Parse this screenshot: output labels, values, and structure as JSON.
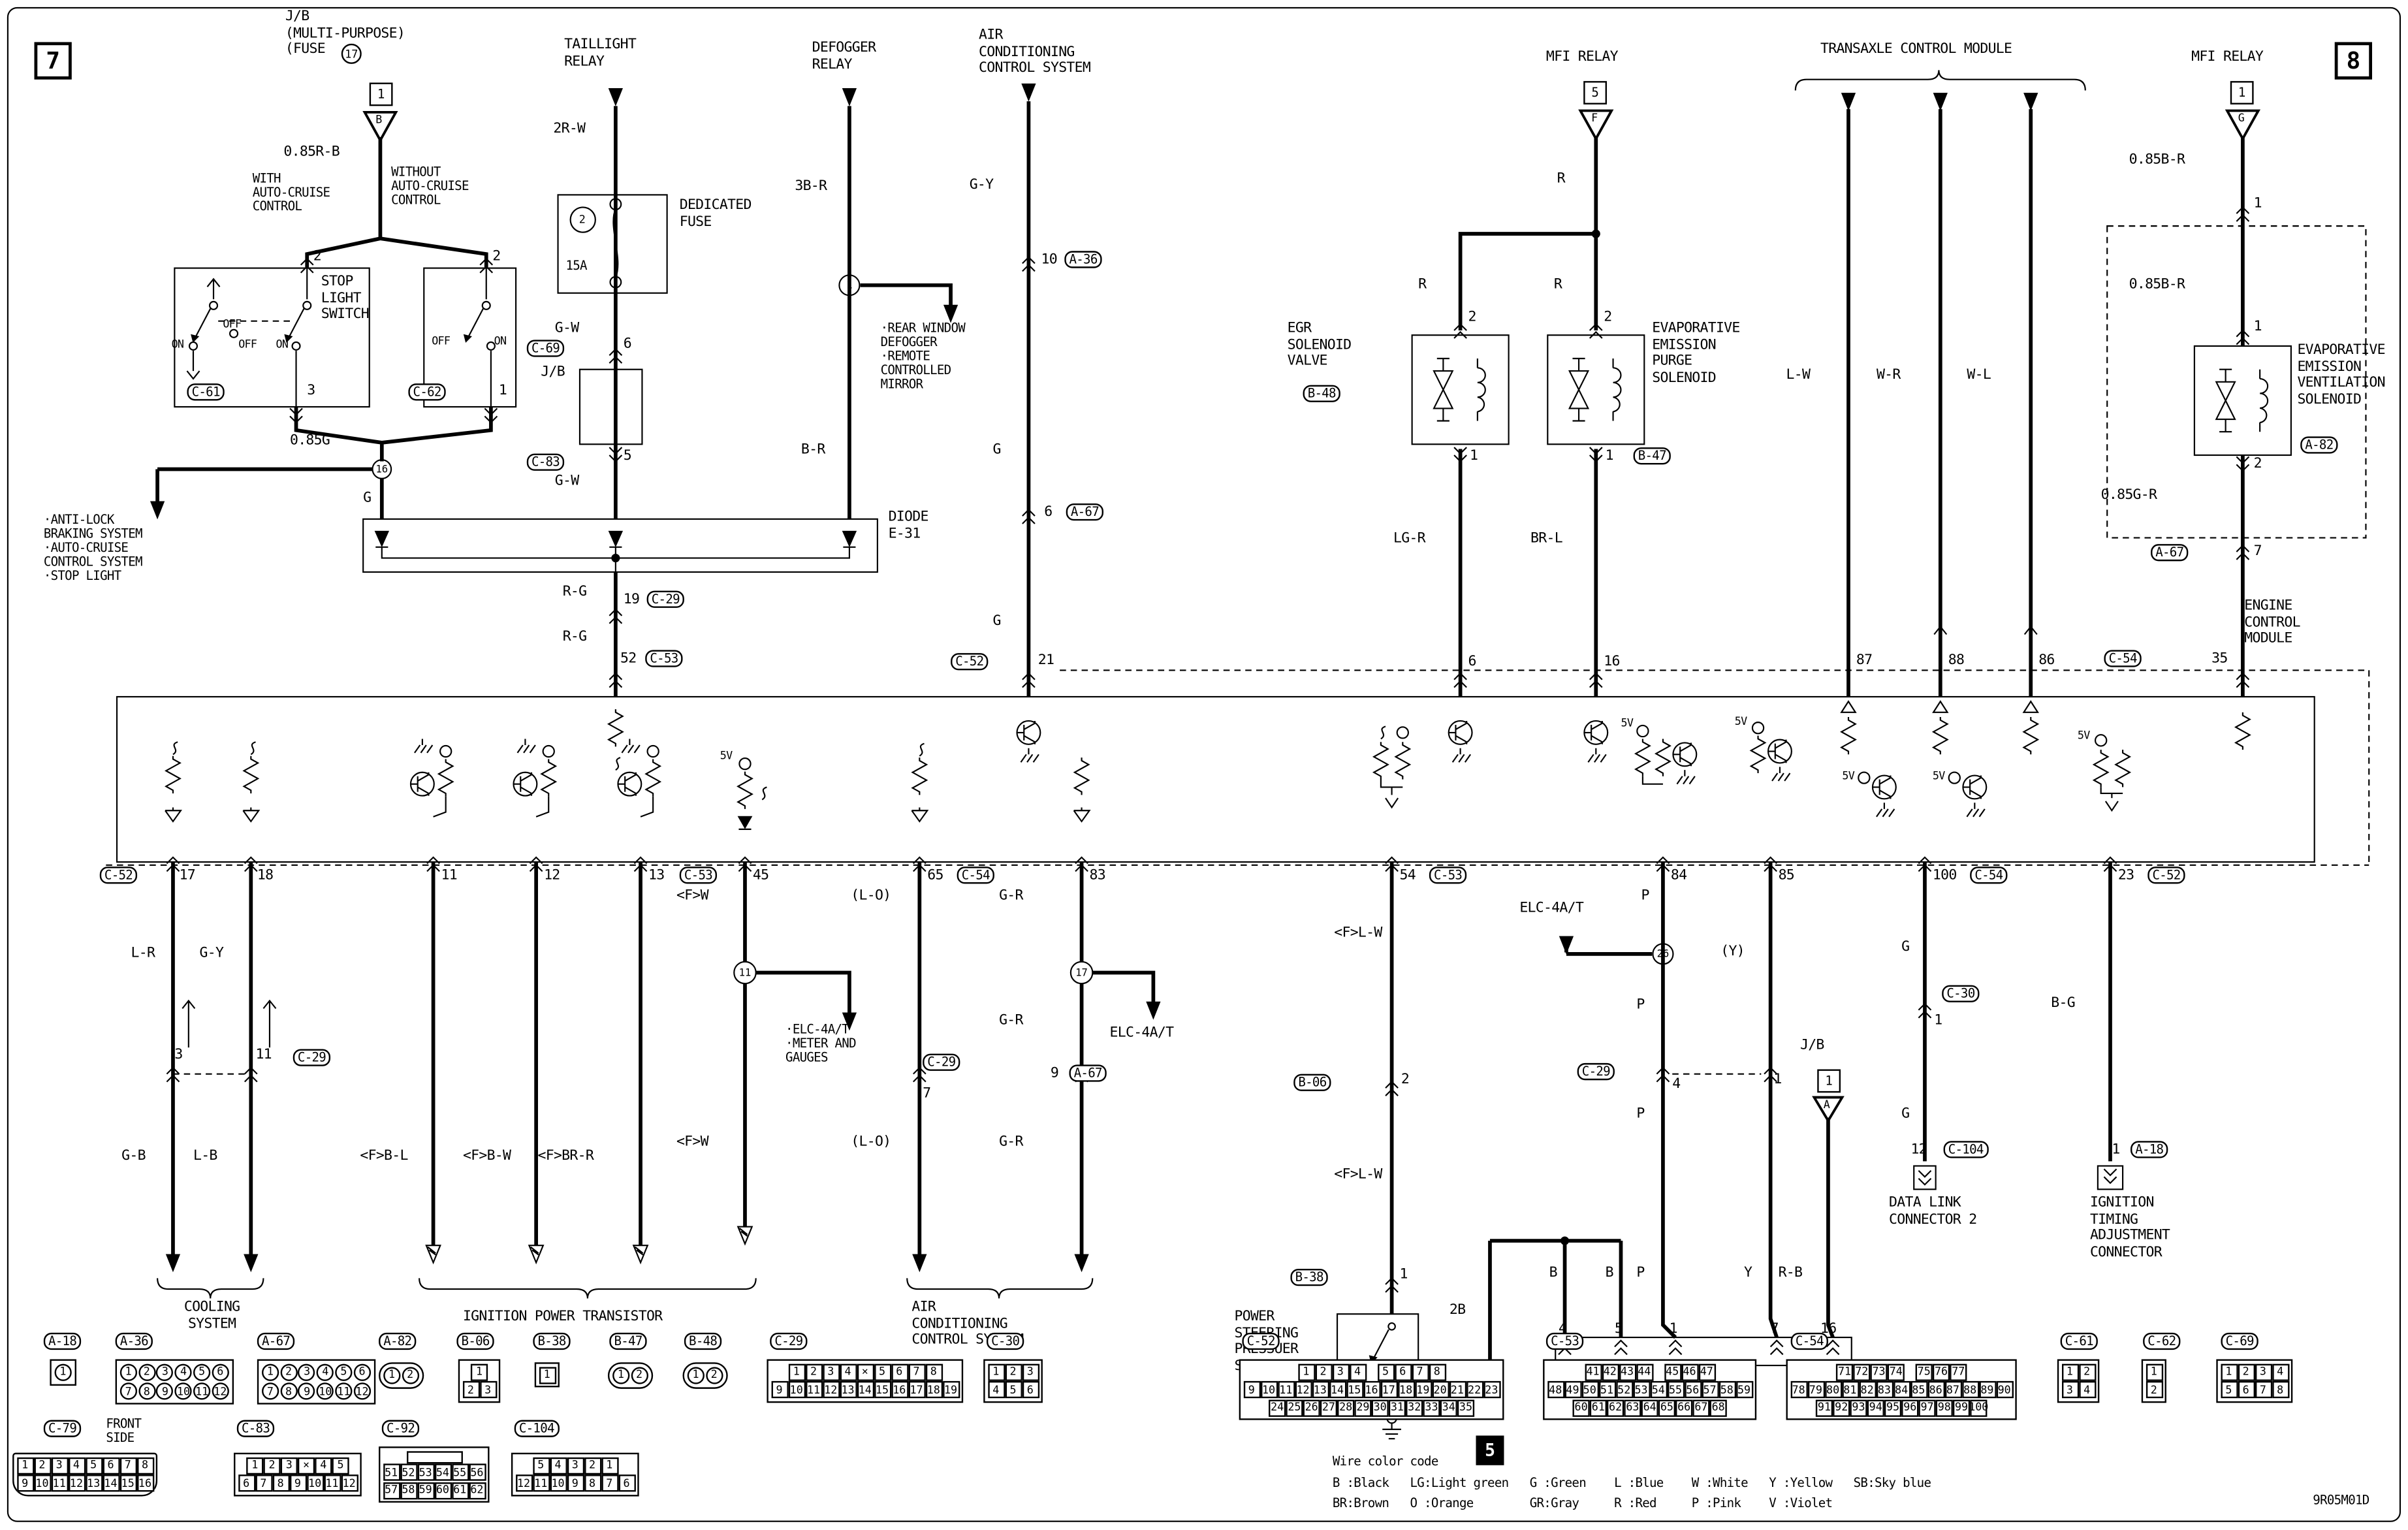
{
  "d": {
    "corner7": "7",
    "corner8": "8",
    "jb_label": "J/B\n(MULTI-PURPOSE)\n(FUSE",
    "jb_fuse_no": "17",
    "pin_b": "1",
    "tri_b": "B",
    "w085rb": "0.85R-B",
    "with_acc": "WITH\nAUTO-CRUISE\nCONTROL",
    "without_acc": "WITHOUT\nAUTO-CRUISE\nCONTROL",
    "p2": "2",
    "sls": "STOP\nLIGHT\nSWITCH",
    "on": "ON",
    "off": "OFF",
    "p3": "3",
    "p1": "1",
    "w085g": "0.85G",
    "j16": "16",
    "abs_list": "·ANTI-LOCK\n BRAKING SYSTEM\n·AUTO-CRUISE\n CONTROL SYSTEM\n·STOP LIGHT",
    "wg": "G",
    "tail_title": "TAILLIGHT\nRELAY",
    "w2rw": "2R-W",
    "dedicated": "DEDICATED\nFUSE",
    "f2": "2",
    "f15": "15A",
    "wgw": "G-W",
    "p6": "6",
    "jb": "J/B",
    "p5": "5",
    "def_title": "DEFOGGER\nRELAY",
    "w3br": "3B-R",
    "j1": "1",
    "def_list": "·REAR WINDOW\n DEFOGGER\n·REMOTE\n CONTROLLED\n MIRROR",
    "wbr": "B-R",
    "diode_name": "DIODE\nE-31",
    "wrg": "R-G",
    "p19": "19",
    "p52": "52",
    "act_title": "AIR\nCONDITIONING\nCONTROL SYSTEM",
    "wgy": "G-Y",
    "p10": "10",
    "p21": "21",
    "mfi": "MFI RELAY",
    "b5": "5",
    "tri_f": "F",
    "wr": "R",
    "egr": "EGR\nSOLENOID\nVALVE",
    "evap": "EVAPORATIVE\nEMISSION\nPURGE\nSOLENOID",
    "wlgr": "LG-R",
    "wbrl": "BR-L",
    "p16": "16",
    "tcm": "TRANSAXLE CONTROL MODULE",
    "wlw": "L-W",
    "wwr": "W-R",
    "wwl": "W-L",
    "p87": "87",
    "p88": "88",
    "p86": "86",
    "b1": "1",
    "tri_g": "G",
    "w085br": "0.85B-R",
    "vent": "EVAPORATIVE\nEMISSION\nVENTILATION\nSOLENOID",
    "w085gr": "0.85G-R",
    "p7": "7",
    "p35": "35",
    "ecm": "ENGINE\nCONTROL\nMODULE",
    "v5": "5V",
    "p17": "17",
    "p18": "18",
    "p11": "11",
    "p12": "12",
    "p13": "13",
    "p45": "45",
    "p65": "65",
    "p83": "83",
    "p54": "54",
    "p84": "84",
    "p85": "85",
    "p100": "100",
    "p23": "23",
    "wlr": "L-R",
    "wgb": "G-B",
    "wlb": "L-B",
    "cooling": "COOLING\nSYSTEM",
    "fbl": "<F>B-L",
    "fbw": "<F>B-W",
    "fbrr": "<F>BR-R",
    "ign": "IGNITION POWER TRANSISTOR",
    "fw": "<F>W",
    "j11": "11",
    "met_list": "·ELC-4A/T\n·METER AND\n GAUGES",
    "lo": "(L-O)",
    "wgr": "G-R",
    "j17": "17",
    "elc": "ELC-4A/T",
    "p9": "9",
    "acb": "AIR\nCONDITIONING\nCONTROL SYSTEM",
    "flw": "<F>L-W",
    "ps": "POWER\nSTEERING\nPRESSUER\nSWITCH",
    "w2b": "2B",
    "wb": "B",
    "blk5": "5",
    "j26": "26",
    "wp": "P",
    "yparen": "(Y)",
    "wy": "Y",
    "wrb": "R-B",
    "p4": "4",
    "dlc1": "DATA LINK CONNECTOR 1",
    "tri_a": "A",
    "dlc2": "DATA LINK\nCONNECTOR 2",
    "p12n": "12",
    "wbg": "B-G",
    "itac": "IGNITION\nTIMING\nADJUSTMENT\nCONNECTOR",
    "front": "FRONT\nSIDE",
    "code": "9R05M01D"
  },
  "tags": {
    "a18": "A-18",
    "a36": "A-36",
    "a67": "A-67",
    "a82": "A-82",
    "b06": "B-06",
    "b38": "B-38",
    "b47": "B-47",
    "b48": "B-48",
    "c29": "C-29",
    "c30": "C-30",
    "c52": "C-52",
    "c53": "C-53",
    "c54": "C-54",
    "c61": "C-61",
    "c62": "C-62",
    "c69": "C-69",
    "c79": "C-79",
    "c83": "C-83",
    "c92": "C-92",
    "c104": "C-104"
  },
  "cc": {
    "title": "Wire color code",
    "line1": "B :Black   LG:Light green   G :Green    L :Blue    W :White   Y :Yellow   SB:Sky blue",
    "line2": "BR:Brown   O :Orange        GR:Gray     R :Red     P :Pink    V :Violet"
  },
  "connectors": {
    "A-18": {
      "shape": "circ",
      "rows": [
        [
          "1"
        ]
      ]
    },
    "A-36": {
      "shape": "circ",
      "rows": [
        [
          "1",
          "2",
          "3",
          "4",
          "5",
          "6"
        ],
        [
          "7",
          "8",
          "9",
          "10",
          "11",
          "12"
        ]
      ]
    },
    "A-67": {
      "shape": "circ",
      "rows": [
        [
          "1",
          "2",
          "3",
          "4",
          "5",
          "6"
        ],
        [
          "7",
          "8",
          "9",
          "10",
          "11",
          "12"
        ]
      ]
    },
    "A-82": {
      "shape": "circ",
      "oval": true,
      "rows": [
        [
          "1",
          "2"
        ]
      ]
    },
    "B-06": {
      "rows": [
        [
          "1"
        ],
        [
          "2",
          "3"
        ]
      ]
    },
    "B-38": {
      "rows": [
        [
          "1"
        ]
      ]
    },
    "B-47": {
      "shape": "circ",
      "oval": true,
      "rows": [
        [
          "1",
          "2"
        ]
      ]
    },
    "B-48": {
      "shape": "circ",
      "oval": true,
      "rows": [
        [
          "1",
          "2"
        ]
      ]
    },
    "C-29": {
      "rows": [
        [
          "1",
          "2",
          "3",
          "4",
          "X",
          "5",
          "6",
          "7",
          "8"
        ],
        [
          "9",
          "10",
          "11",
          "12",
          "13",
          "14",
          "15",
          "16",
          "17",
          "18",
          "19"
        ]
      ]
    },
    "C-30": {
      "rows": [
        [
          "1",
          "2",
          "3"
        ],
        [
          "4",
          "5",
          "6"
        ]
      ]
    },
    "C-52": {
      "rows": [
        [
          "1",
          "2",
          "3",
          "4",
          "",
          "5",
          "6",
          "7",
          "8"
        ],
        [
          "9",
          "10",
          "11",
          "12",
          "13",
          "14",
          "15",
          "16",
          "17",
          "18",
          "19",
          "20",
          "21",
          "22",
          "23"
        ],
        [
          "24",
          "25",
          "26",
          "27",
          "28",
          "29",
          "30",
          "31",
          "32",
          "33",
          "34",
          "35"
        ]
      ]
    },
    "C-53": {
      "rows": [
        [
          "41",
          "42",
          "43",
          "44",
          "",
          "45",
          "46",
          "47"
        ],
        [
          "48",
          "49",
          "50",
          "51",
          "52",
          "53",
          "54",
          "55",
          "56",
          "57",
          "58",
          "59"
        ],
        [
          "60",
          "61",
          "62",
          "63",
          "64",
          "65",
          "66",
          "67",
          "68"
        ]
      ]
    },
    "C-54": {
      "rows": [
        [
          "71",
          "72",
          "73",
          "74",
          "",
          "75",
          "76",
          "77"
        ],
        [
          "78",
          "79",
          "80",
          "81",
          "82",
          "83",
          "84",
          "85",
          "86",
          "87",
          "88",
          "89",
          "90"
        ],
        [
          "91",
          "92",
          "93",
          "94",
          "95",
          "96",
          "97",
          "98",
          "99",
          "100"
        ]
      ]
    },
    "C-61": {
      "rows": [
        [
          "1",
          "2"
        ],
        [
          "3",
          "4"
        ]
      ]
    },
    "C-62": {
      "rows": [
        [
          "1"
        ],
        [
          "2"
        ]
      ]
    },
    "C-69": {
      "rows": [
        [
          "1",
          "2",
          "3",
          "4"
        ],
        [
          "5",
          "6",
          "7",
          "8"
        ]
      ]
    },
    "C-79": {
      "rows": [
        [
          "1",
          "2",
          "3",
          "4",
          "5",
          "6",
          "7",
          "8"
        ],
        [
          "9",
          "10",
          "11",
          "12",
          "13",
          "14",
          "15",
          "16"
        ]
      ]
    },
    "C-83": {
      "rows": [
        [
          "1",
          "2",
          "3",
          "X",
          "4",
          "5"
        ],
        [
          "6",
          "7",
          "8",
          "9",
          "10",
          "11",
          "12"
        ]
      ]
    },
    "C-92": {
      "toprect": true,
      "rows": [
        [
          "51",
          "52",
          "53",
          "54",
          "55",
          "56"
        ],
        [
          "57",
          "58",
          "59",
          "60",
          "61",
          "62"
        ]
      ]
    },
    "C-104": {
      "rows": [
        [
          "5",
          "4",
          "3",
          "2",
          "1"
        ],
        [
          "12",
          "11",
          "10",
          "9",
          "8",
          "7",
          "6"
        ]
      ]
    }
  }
}
